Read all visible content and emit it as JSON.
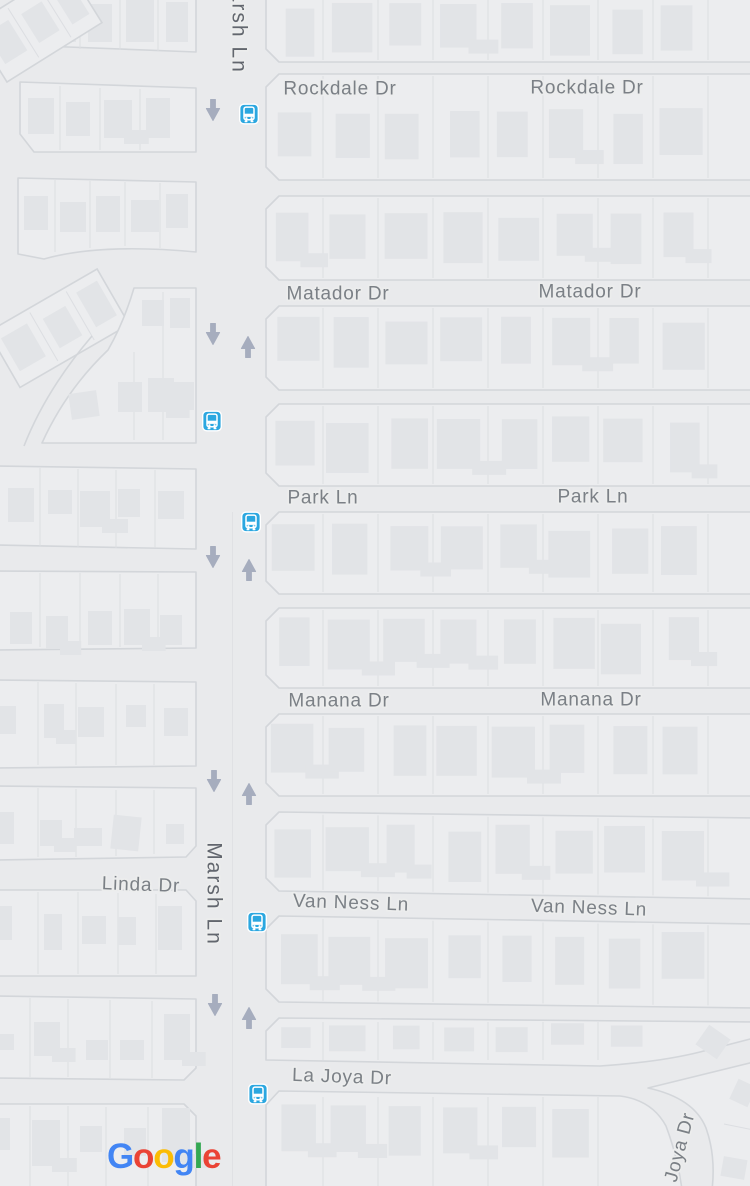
{
  "app": {
    "title": "Google Maps street map view"
  },
  "map": {
    "colors": {
      "background": "#e9eaec",
      "block": "#ecedef",
      "casing": "#d3d6da",
      "lot_line": "#dcdee2",
      "building": "#e2e4e7",
      "street_label": "#7b8086",
      "major_label": "#62666e",
      "label_halo": "#eceded",
      "arrow": "#a6adbe",
      "transit_blue": "#2ba7e0",
      "median_line": "#e0e1e4"
    },
    "street_labels": [
      {
        "text": "Marsh Ln",
        "x": 240,
        "y": 22,
        "rotate": 90,
        "kind": "major"
      },
      {
        "text": "Marsh Ln",
        "x": 215,
        "y": 894,
        "rotate": 90,
        "kind": "major"
      },
      {
        "text": "Rockdale Dr",
        "x": 340,
        "y": 88,
        "rotate": 0,
        "kind": "street"
      },
      {
        "text": "Rockdale Dr",
        "x": 587,
        "y": 87,
        "rotate": 0,
        "kind": "street"
      },
      {
        "text": "Matador Dr",
        "x": 338,
        "y": 293,
        "rotate": 0,
        "kind": "street"
      },
      {
        "text": "Matador Dr",
        "x": 590,
        "y": 291,
        "rotate": 0,
        "kind": "street"
      },
      {
        "text": "Park Ln",
        "x": 323,
        "y": 497,
        "rotate": 0,
        "kind": "street"
      },
      {
        "text": "Park Ln",
        "x": 593,
        "y": 496,
        "rotate": 0,
        "kind": "street"
      },
      {
        "text": "Manana Dr",
        "x": 339,
        "y": 700,
        "rotate": 0,
        "kind": "street"
      },
      {
        "text": "Manana Dr",
        "x": 591,
        "y": 699,
        "rotate": 0,
        "kind": "street"
      },
      {
        "text": "Linda Dr",
        "x": 141,
        "y": 884,
        "rotate": 2,
        "kind": "street"
      },
      {
        "text": "Van Ness Ln",
        "x": 351,
        "y": 902,
        "rotate": 2,
        "kind": "street"
      },
      {
        "text": "Van Ness Ln",
        "x": 589,
        "y": 907,
        "rotate": 2,
        "kind": "street"
      },
      {
        "text": "La Joya Dr",
        "x": 342,
        "y": 1076,
        "rotate": 2,
        "kind": "street"
      },
      {
        "text": "Joya Dr",
        "x": 679,
        "y": 1147,
        "rotate": -75,
        "kind": "street"
      }
    ],
    "transit_stops": [
      {
        "x": 249,
        "y": 114
      },
      {
        "x": 212,
        "y": 421
      },
      {
        "x": 251,
        "y": 522
      },
      {
        "x": 257,
        "y": 922
      },
      {
        "x": 258,
        "y": 1094
      }
    ],
    "oneway_arrows": [
      {
        "x": 213,
        "y": 111,
        "dir": "down"
      },
      {
        "x": 213,
        "y": 335,
        "dir": "down"
      },
      {
        "x": 248,
        "y": 346,
        "dir": "up"
      },
      {
        "x": 213,
        "y": 558,
        "dir": "down"
      },
      {
        "x": 249,
        "y": 569,
        "dir": "up"
      },
      {
        "x": 214,
        "y": 782,
        "dir": "down"
      },
      {
        "x": 249,
        "y": 793,
        "dir": "up"
      },
      {
        "x": 215,
        "y": 1006,
        "dir": "down"
      },
      {
        "x": 249,
        "y": 1017,
        "dir": "up"
      }
    ]
  },
  "attribution": {
    "logo_text": "Google",
    "logo_letter_colors": [
      "#4285F4",
      "#EA4335",
      "#FBBC05",
      "#4285F4",
      "#34A853",
      "#EA4335"
    ]
  }
}
